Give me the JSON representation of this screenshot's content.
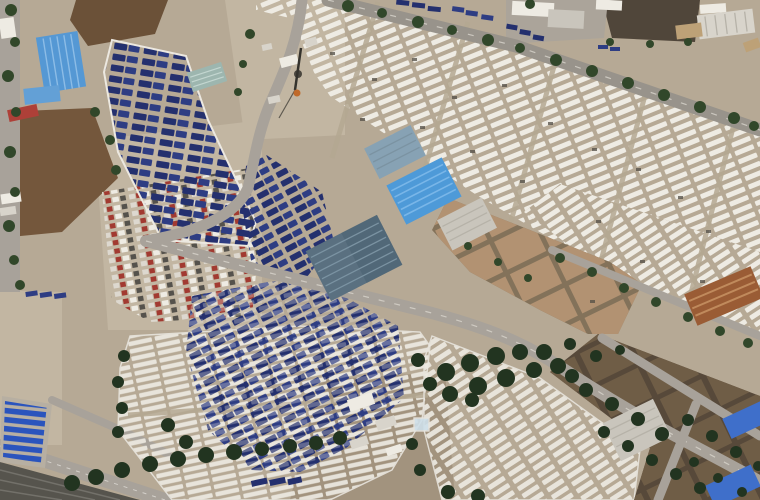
{
  "scene": {
    "type": "satellite-aerial-photograph",
    "subject": "large vehicle storage and logistics yard with warehouses, truck lots and solar panels",
    "regions": {
      "top_left": "tree-lined street with blue-roofed warehouse, small blue shed and red-roofed shed beside dirt fields",
      "top_center": "gate area with tower, small white buildings and access road",
      "top_right": "tree-lined highway with industrial buildings and a dark field above it",
      "center": "row of warehouses with bright blue, slate-blue and gray roofs",
      "center_right": "grid of tan-roofed warehouse blocks and a rust-roofed shed",
      "left_wedge": "white-bordered wedge lot filled with rows of dark blue trucks",
      "center_left": "open lot with rows of mixed-color cars",
      "blue_mass": "dense triangular lot of blue tarped vehicles",
      "white_lots": "very large lots of white vehicles parked in diagonal rows",
      "bottom_left": "blue solar panel array, light access road and dark railway tracks",
      "bottom_band": "dense tree band along service road",
      "bottom_right": "rows of brown-roofed warehouses, one gray warehouse and blue-roofed buildings"
    }
  },
  "palette": {
    "ground": "#b6a995",
    "groundLight": "#c2b6a2",
    "groundDark": "#a2937e",
    "fieldBrown": "#6b5138",
    "fieldBrown2": "#74573c",
    "fieldDark": "#50463a",
    "road": "#a8a29a",
    "roadDark": "#98938b",
    "railDark": "#56544d",
    "padGray": "#aba49a",
    "vanWhite": "#eeebe3",
    "shedWhite": "#d8d4cb",
    "truckNavy": "#24306e",
    "truckNavy2": "#2e3d83",
    "solarBlue": "#2a54bd",
    "solarBase": "#b7afa2",
    "treeGreen": "#31472a",
    "treeGreenDark": "#223420",
    "roofBlue": "#5598d4",
    "roofBlueSmall": "#63a0d6",
    "roofBrightBlue": "#4e9ad8",
    "roofBlueGray": "#87a2b4",
    "roofSlate": "#5a7080",
    "roofSlateDark": "#4a6271",
    "roofGray": "#c9c5bc",
    "roofTan": "#b29272",
    "roofTanGap": "#83725a",
    "roofBrown": "#6f5d46",
    "roofBrownGap": "#57493a",
    "roofRust": "#9a5c35",
    "roofRed": "#ae4038",
    "roofTeal": "#9db6af",
    "roofTanSmall": "#bda177",
    "roofBlueBR": "#3f6fca",
    "lightBlueShed": "#cfe0ea",
    "orange": "#c06a2a",
    "mixedRed": "#a23a31",
    "mixedGray": "#55524c",
    "mixedWhite": "#ddd8cf"
  }
}
